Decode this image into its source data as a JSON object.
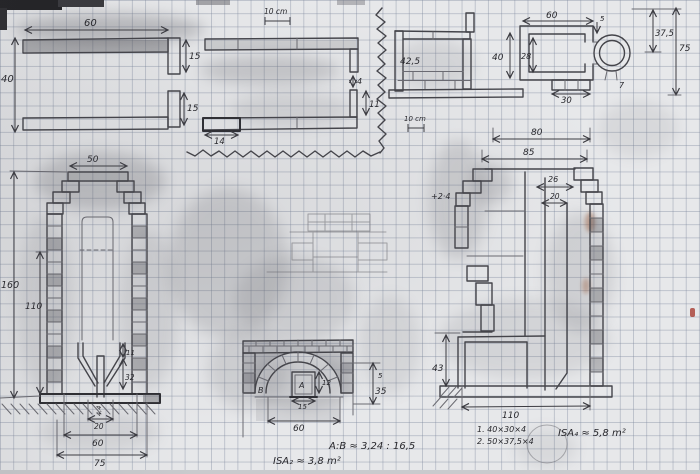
{
  "meta": {
    "description": "Scanned hand-drawn pencil construction sketch of a masonry heater / fireplace on squared graph paper"
  },
  "scalebars": {
    "top": "10 cm",
    "mid": "10 cm"
  },
  "plan_top_left": {
    "width": "60",
    "height": "40",
    "t_upper": "15",
    "t_lower": "15"
  },
  "plan_top_mid": {
    "gap": "4",
    "offset": "11",
    "base": "14"
  },
  "plan_firebox": {
    "depth": "42,5"
  },
  "plan_stove_top": {
    "width": "60",
    "height": "40",
    "inner": "28",
    "ledge": "30",
    "small": "5"
  },
  "pipe": {
    "diameter": "37,5",
    "height": "75",
    "small": "7"
  },
  "left_elevation": {
    "top_width": "50",
    "height": "160",
    "inner_height": "110",
    "neck": "11",
    "funnel": "32",
    "pipe_w": "4,4",
    "b20": "20",
    "b60": "60",
    "b75": "75"
  },
  "arch_front": {
    "door_label": "A",
    "b_label": "B",
    "door_height": "12",
    "door_width": "15",
    "small": "5",
    "opening_height": "35",
    "opening_width": "60"
  },
  "right_section": {
    "width_outer": "80",
    "width_base": "85",
    "flue1": "26",
    "flue2": "20",
    "note": "+2·4",
    "firebox_height": "43",
    "base_width": "110"
  },
  "notes": {
    "ratio": "A:B ≈ 3,24 : 16,5",
    "isa2": "ISA₂ ≈ 3,8 m²",
    "brick1": "1. 40×30×4",
    "brick2": "2. 50×37,5×4",
    "isa4": "ISA₄ ≈ 5,8 m²"
  }
}
